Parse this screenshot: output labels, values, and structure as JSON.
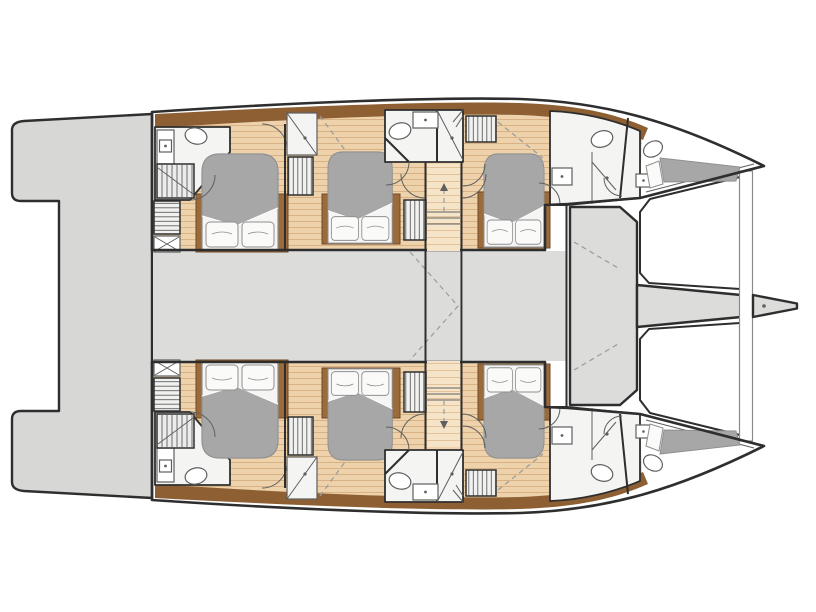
{
  "plan": {
    "kind": "catamaran-yacht-deck-plan",
    "orientation": "bow-right",
    "symmetry": "two mirrored hulls about horizontal centerline",
    "rooms": {
      "double_cabins": 6,
      "bow_berths": 2,
      "bathrooms": 8,
      "shower_stalls": 4,
      "saloon_deck": 1,
      "central_corridor": 1,
      "aft_platform": 1,
      "trampolines": 2,
      "bowsprit": 1,
      "staircases": 2,
      "wardrobes": 8
    },
    "furniture_per_cabin": {
      "bed": 1,
      "pillows": 2
    }
  },
  "palette": {
    "background": "#ffffff",
    "outline": "#2e2e2e",
    "deck_gray": "#dcdcdb",
    "platform_gray": "#d7d7d6",
    "trampoline": "#ffffff",
    "beam_stroke": "#8a8a8a",
    "wood_floor": "#edd2ab",
    "wood_line": "#d8b184",
    "wood_light": "#f6e4c8",
    "wood_light_line": "#e3c29a",
    "deck_brown": "#8d5f33",
    "platform_brown": "#9c6b3c",
    "platform_brown_edge": "#6f4a24",
    "mattress_gray": "#a7a7a7",
    "linen": "#f5f5f4",
    "linen_stroke": "#8f8f8f",
    "bathroom_white": "#f4f4f3",
    "fixture_stroke": "#5f5f5f",
    "hatch_bg": "#f1f1f0",
    "hatch_line": "#606060",
    "dash": "#9b9b9b"
  }
}
